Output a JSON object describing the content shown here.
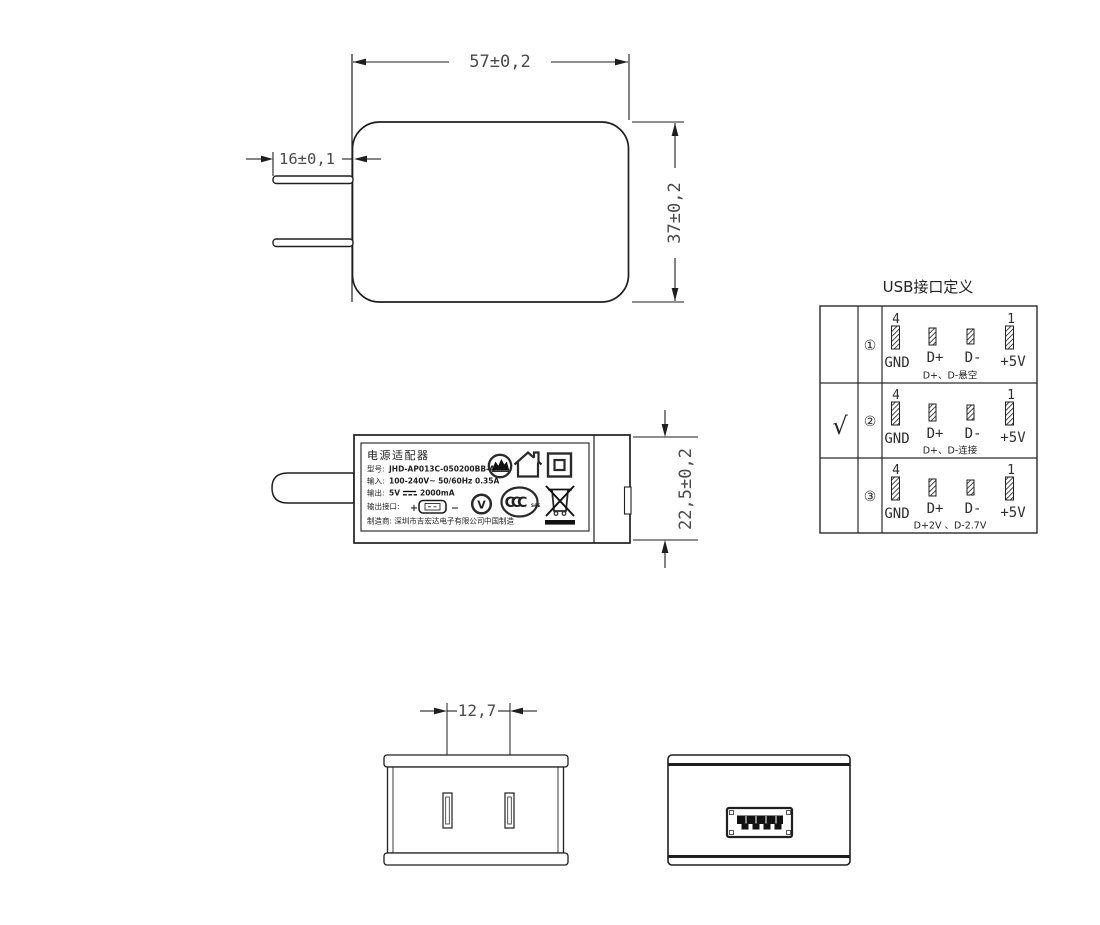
{
  "colors": {
    "line": "#1f1f1f",
    "dim_text": "#4a4a4a",
    "text": "#222222"
  },
  "front_view": {
    "width_dim": "57±0,2",
    "prong_dim": "16±0,1",
    "height_dim": "37±0,2"
  },
  "side_view": {
    "depth_dim": "22,5±0,2",
    "label": {
      "title": "电源适配器",
      "model_key": "型号:",
      "model_value": "JHD-AP013C-050200BB-A",
      "input_key": "输入:",
      "input_value": "100-240V~  50/60Hz  0.35A",
      "output_key": "输出:",
      "output_voltage": "5V",
      "output_current": "2000mA",
      "port_key": "输出接口:",
      "plus": "+",
      "minus": "−",
      "mfr": "制造商: 深圳市吉宏达电子有限公司",
      "made_in": "中国制造",
      "efficiency_letter": "V",
      "ccc_letters": "CCC",
      "ccc_sub": "S&E"
    }
  },
  "usb_table": {
    "title": "USB接口定义",
    "pin_top_left": "4",
    "pin_top_right": "1",
    "pins": [
      "GND",
      "D+",
      "D-",
      "+5V"
    ],
    "rows": [
      {
        "check": "",
        "num": "①",
        "note": "D+、D-悬空"
      },
      {
        "check": "√",
        "num": "②",
        "note": "D+、D-连接"
      },
      {
        "check": "",
        "num": "③",
        "note": "D+2V 、D-2.7V"
      }
    ]
  },
  "bottom_views": {
    "prong_pitch_dim": "12,7"
  }
}
